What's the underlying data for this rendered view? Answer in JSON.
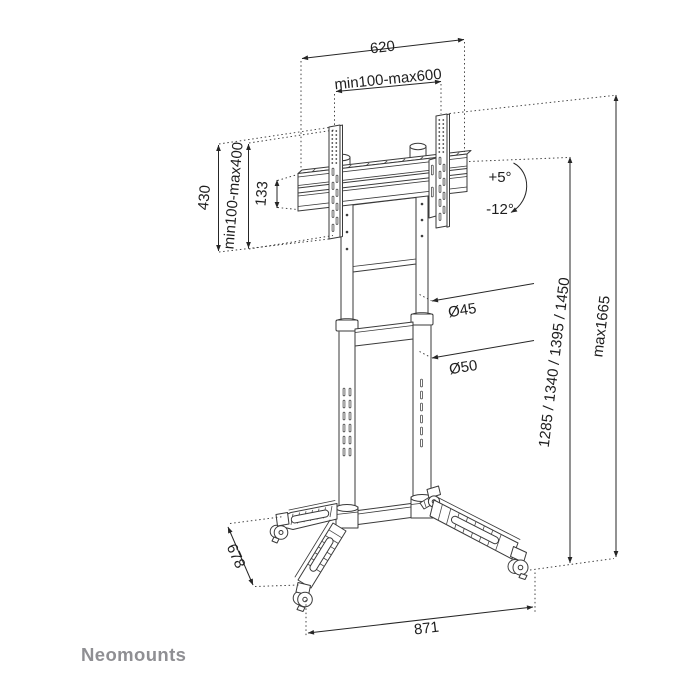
{
  "page": {
    "background": "#ffffff"
  },
  "brand": {
    "logo_text": "Neomounts",
    "logo_color": "#8f8f93"
  },
  "drawing": {
    "type": "technical-line-drawing",
    "subject": "mobile display floor stand with casters",
    "line_color": "#3a3a3a",
    "labels": {
      "bracket_width_mm": "620",
      "vesa_width_range": "min100-max600",
      "bracket_height_mm": "430",
      "vesa_height_range": "min100-max400",
      "rail_height_mm": "133",
      "tilt_up": "+5°",
      "tilt_down": "-12°",
      "upper_pole_diameter": "Ø45",
      "lower_pole_diameter": "Ø50",
      "display_heights_mm": "1285 / 1340 / 1395 / 1450",
      "max_height": "max1665",
      "base_depth_mm": "678",
      "base_width_mm": "871"
    }
  }
}
